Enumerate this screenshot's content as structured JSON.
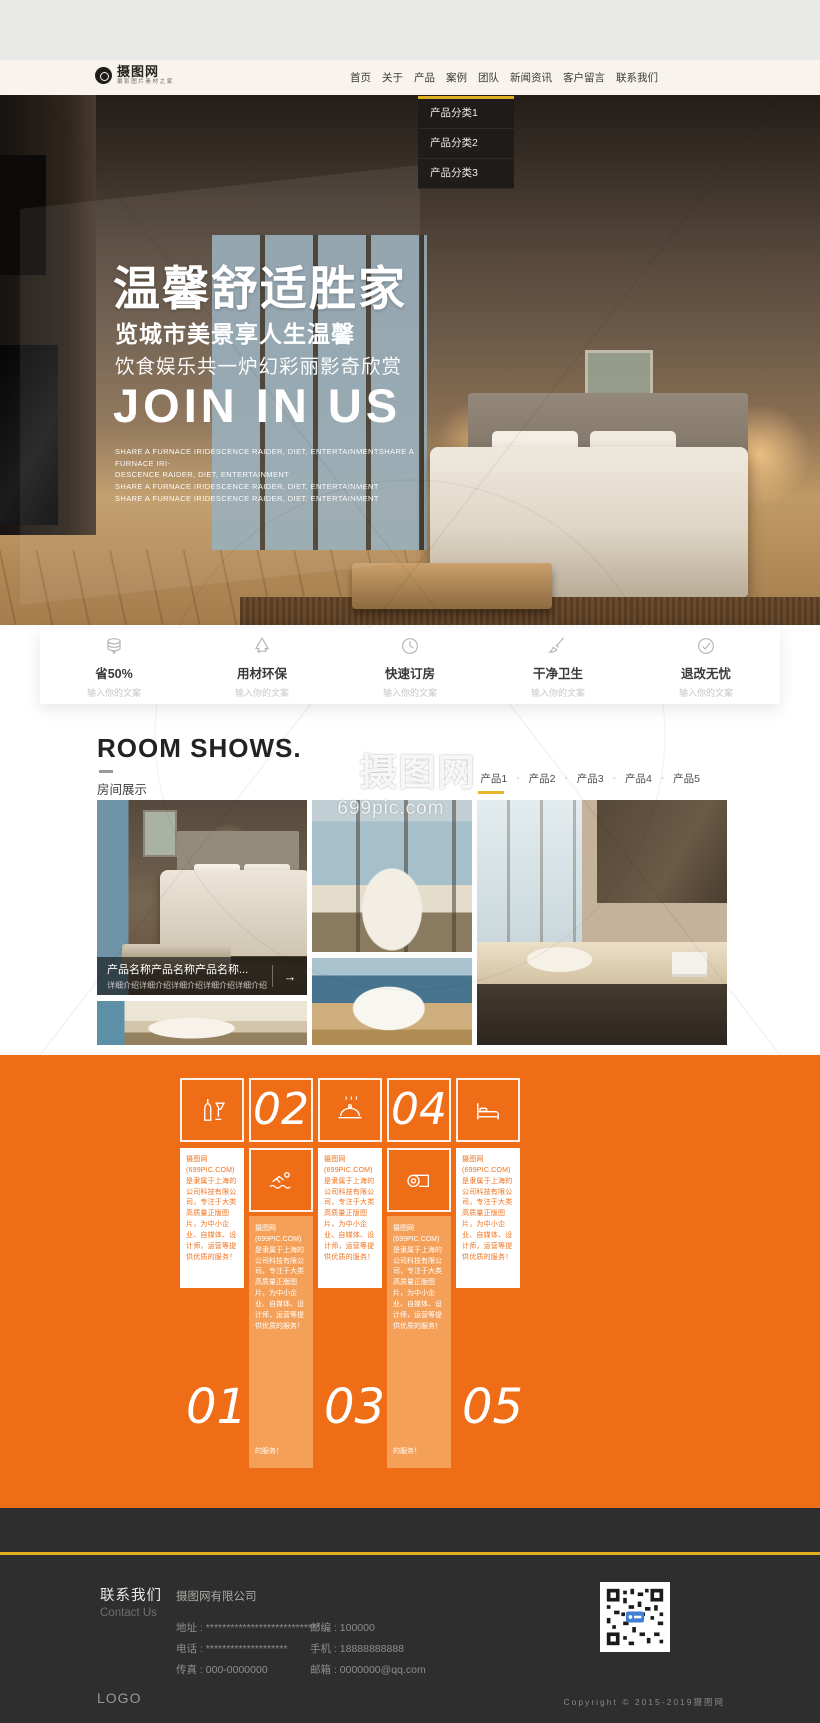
{
  "colors": {
    "accent_orange": "#f06d18",
    "accent_yellow": "#e2ae22",
    "footer_dark": "#2e2e2e",
    "header_cream": "#f8f4ed"
  },
  "header": {
    "logo": {
      "brand": "摄图网",
      "tagline": "摄影图片素材之家"
    },
    "nav": {
      "items": [
        "首页",
        "关于",
        "产品",
        "案例",
        "团队",
        "新闻资讯",
        "客户留言",
        "联系我们"
      ]
    },
    "dropdown": {
      "items": [
        "产品分类1",
        "产品分类2",
        "产品分类3"
      ]
    }
  },
  "hero": {
    "title": "温馨舒适胜家",
    "subtitle1": "览城市美景享人生温馨",
    "subtitle2": "饮食娱乐共一炉幻彩丽影奇欣赏",
    "heading_en": "JOIN IN US",
    "desc_lines": "SHARE A FURNACE IRIDESCENCE RAIDER, DIET, ENTERTAINMENTSHARE A FURNACE IRI-\nDESCENCE RAIDER, DIET, ENTERTAINMENT\nSHARE A FURNACE IRIDESCENCE RAIDER, DIET, ENTERTAINMENT\nSHARE A FURNACE IRIDESCENCE RAIDER, DIET, ENTERTAINMENT"
  },
  "features": {
    "items": [
      {
        "icon": "coins-icon",
        "title": "省50%",
        "sub": "输入你的文案"
      },
      {
        "icon": "recycle-icon",
        "title": "用材环保",
        "sub": "输入你的文案"
      },
      {
        "icon": "clock-icon",
        "title": "快速订房",
        "sub": "输入你的文案"
      },
      {
        "icon": "brush-icon",
        "title": "干净卫生",
        "sub": "输入你的文案"
      },
      {
        "icon": "check-icon",
        "title": "退改无忧",
        "sub": "输入你的文案"
      }
    ]
  },
  "room_shows": {
    "title": "ROOM SHOWS.",
    "subtitle": "房间展示",
    "tabs": [
      "产品1",
      "产品2",
      "产品3",
      "产品4",
      "产品5"
    ],
    "separator": "-",
    "caption_title": "产品名称产品名称产品名称...",
    "caption_desc": "详细介绍详细介绍详细介绍详细介绍详细介绍",
    "caption_arrow": "→"
  },
  "watermark": {
    "brand": "摄图网",
    "domain": "699pic.com",
    "icon": "camera-aperture-icon"
  },
  "promo": {
    "icons": [
      "wine-bottle-icon",
      "swimmer-icon",
      "cloche-icon",
      "towel-icon",
      "bed-icon"
    ],
    "numbers": [
      "01",
      "02",
      "03",
      "04",
      "05"
    ],
    "blurb": "摄图网(699PIC.COM)是隶属于上海的公司科技有限公司，专注于大类高质量正版图片，为中小企业、自媒体、设计师，运营等提供优质的服务！",
    "blurb_tail": "的服务！"
  },
  "footer": {
    "contact_cn": "联系我们",
    "contact_en": "Contact Us",
    "company": "摄图网有限公司",
    "rows_left": [
      {
        "label": "地址 :",
        "value": "****************************"
      },
      {
        "label": "电话 :",
        "value": "********************"
      },
      {
        "label": "传真 :",
        "value": "000-0000000"
      }
    ],
    "rows_right": [
      {
        "label": "邮编 :",
        "value": "100000"
      },
      {
        "label": "手机 :",
        "value": "18888888888"
      },
      {
        "label": "邮箱 :",
        "value": "0000000@qq.com"
      }
    ],
    "logo": "LOGO",
    "copyright": "Copyright © 2015-2019摄图网"
  }
}
